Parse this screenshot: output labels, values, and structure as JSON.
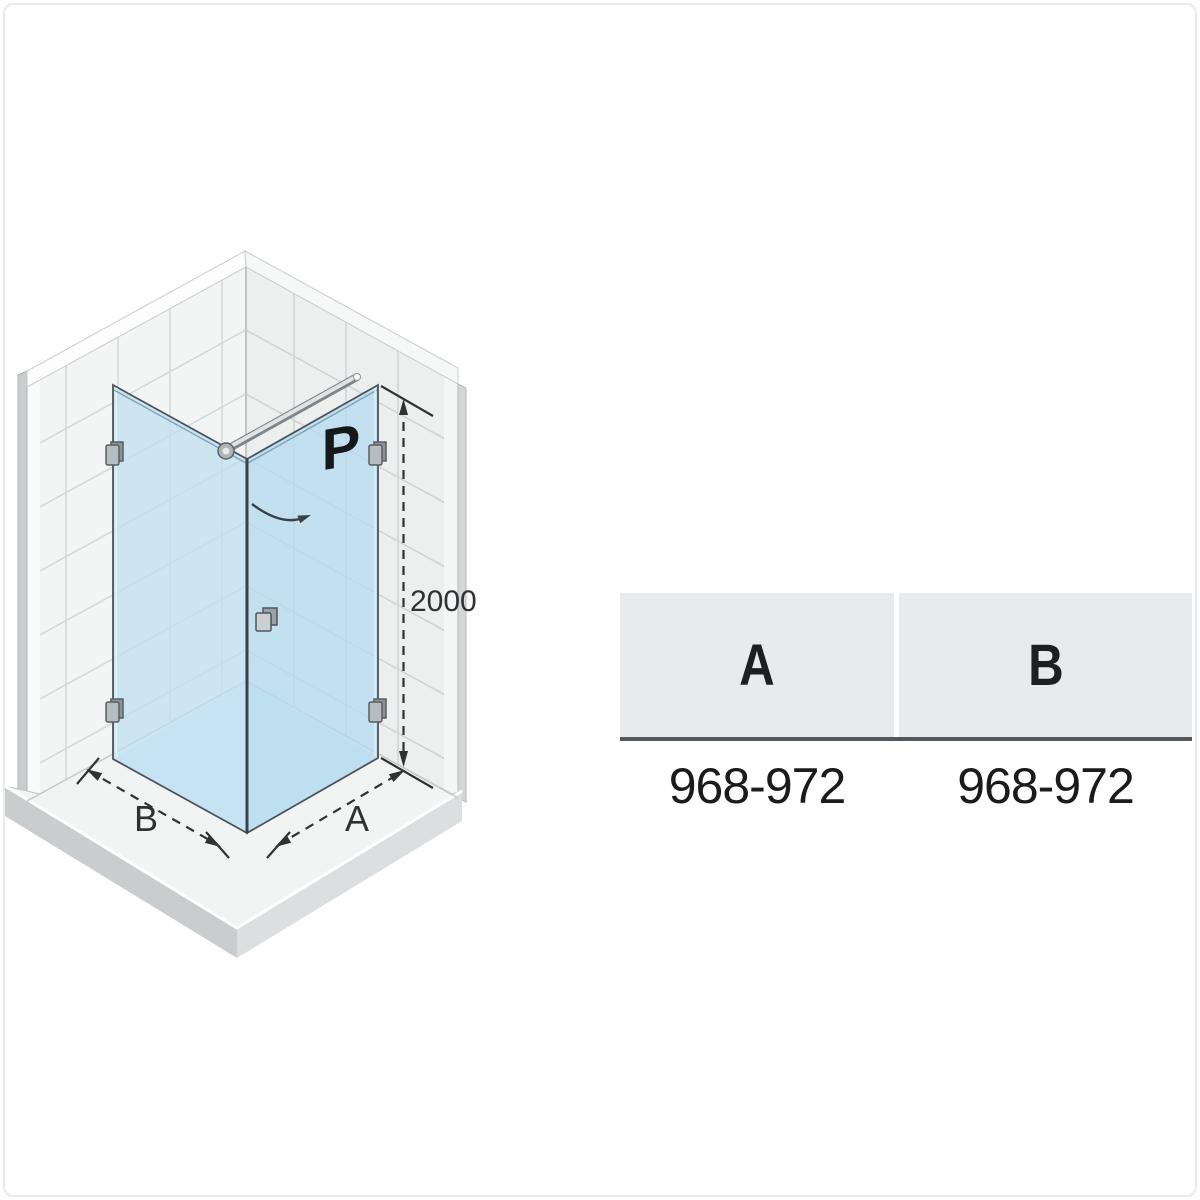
{
  "diagram": {
    "door_label": "P",
    "height_dimension": "2000",
    "width_dimension_left": "B",
    "width_dimension_right": "A"
  },
  "table": {
    "columns": [
      {
        "header": "A",
        "value": "968-972"
      },
      {
        "header": "B",
        "value": "968-972"
      }
    ]
  },
  "colors": {
    "glass": "#bedff0",
    "glass_interior_floor": "#d6ebf7",
    "tile_left_wall": "#f3f4f4",
    "tile_right_wall": "#edefef",
    "tile_grout": "#d6d9da",
    "tray_side": "#cdd1d2",
    "chrome_bar": "#dfe3e4",
    "table_header_bg": "#e9eaeb",
    "table_rule": "#54575a",
    "dimension_ink": "#2f3133"
  }
}
